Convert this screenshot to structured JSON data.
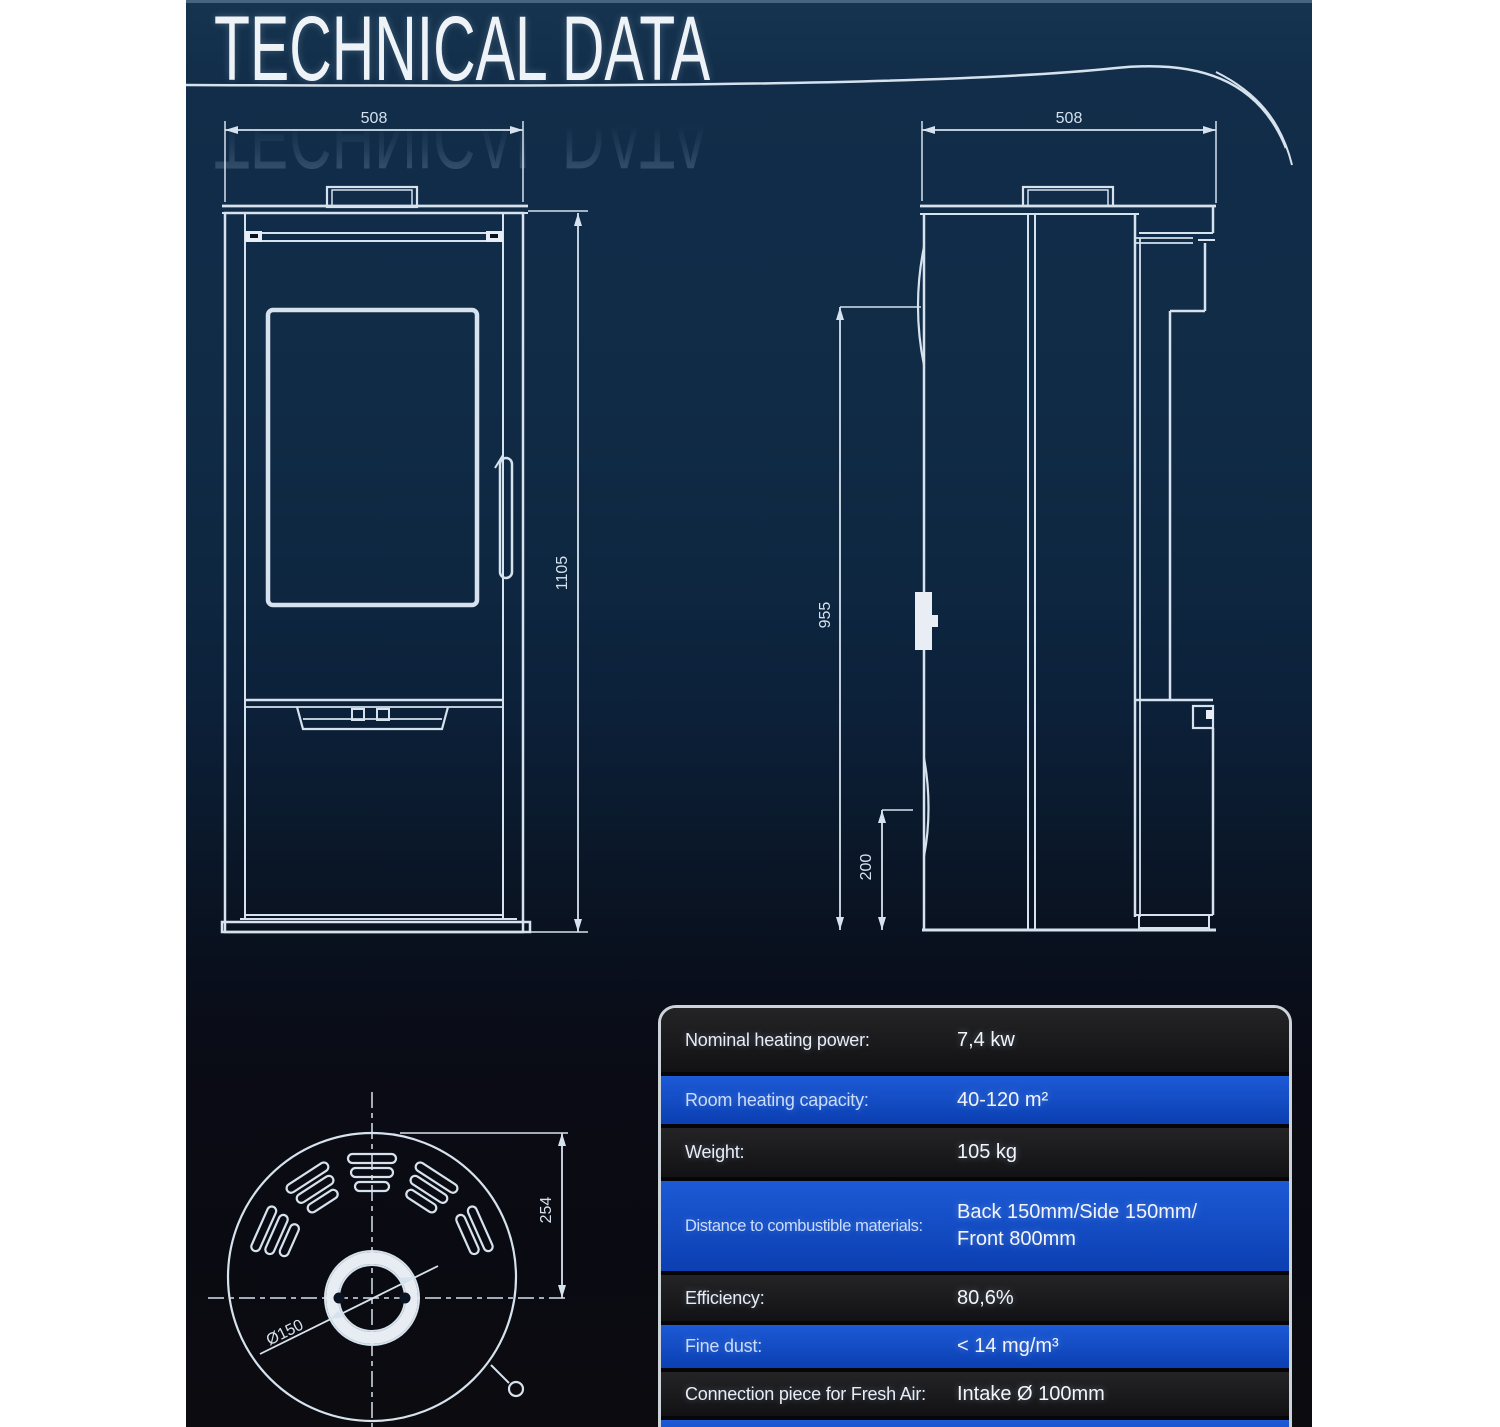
{
  "title": {
    "text": "TECHNICAL DATA"
  },
  "drawings": {
    "front_view": {
      "width_mm": "508",
      "height_mm": "1105"
    },
    "side_view": {
      "depth_mm": "508",
      "rear_height_mm": "955",
      "lower_clearance_mm": "200"
    },
    "top_view": {
      "flue_center_offset_mm": "254",
      "flue_diameter": "Ø150"
    }
  },
  "spec_table": {
    "rows": [
      {
        "label": "Nominal heating power:",
        "value": "7,4 kw",
        "value2": ""
      },
      {
        "label": "Room heating capacity:",
        "value": "40-120 m²",
        "value2": ""
      },
      {
        "label": "Weight:",
        "value": "105 kg",
        "value2": ""
      },
      {
        "label": "Distance to combustible materials:",
        "value": "Back 150mm/Side 150mm/",
        "value2": "Front 800mm"
      },
      {
        "label": "Efficiency:",
        "value": "80,6%",
        "value2": ""
      },
      {
        "label": "Fine dust:",
        "value": "< 14 mg/m³",
        "value2": ""
      },
      {
        "label": "Connection piece for Fresh Air:",
        "value": "Intake Ø 100mm",
        "value2": ""
      },
      {
        "label": "",
        "value": "",
        "value2": ""
      }
    ]
  },
  "colors": {
    "accent_blue": "#1550c8",
    "row_dark": "#1a1a1c",
    "line": "#d6e2ed",
    "background_navy": "#102b46"
  }
}
